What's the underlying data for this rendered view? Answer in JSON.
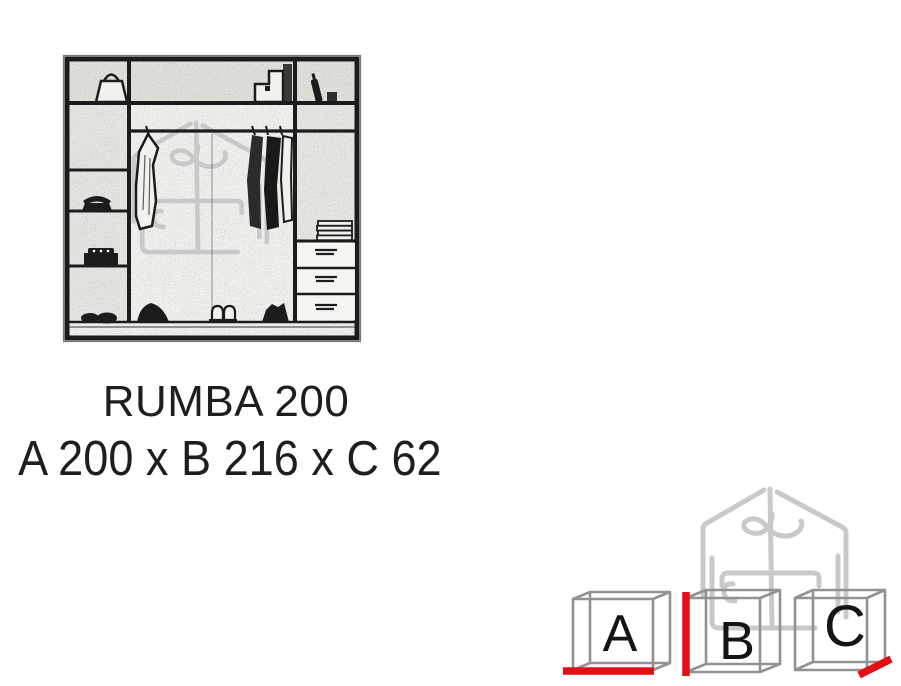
{
  "product": {
    "name": "RUMBA 200",
    "dimensions_label": "A 200 x B 216 x C 62"
  },
  "dimension_cubes": [
    {
      "label": "A",
      "dimension": "width",
      "value": "200",
      "highlighted_edge": "bottom-front"
    },
    {
      "label": "B",
      "dimension": "height",
      "value": "216",
      "highlighted_edge": "left-front"
    },
    {
      "label": "C",
      "dimension": "depth",
      "value": "62",
      "highlighted_edge": "bottom-right-receding"
    }
  ],
  "diagram": {
    "type": "wardrobe interior sketch",
    "depicts": [
      "shelves with bag",
      "hanging rail with clothes",
      "three drawers",
      "folded linens",
      "shoes",
      "telephone",
      "bottle"
    ]
  },
  "watermark": {
    "icon": "house-hanger-furniture-logo"
  },
  "colors": {
    "accent_red": "#e30f17",
    "cube_gray": "#8f9394",
    "watermark_gray": "#c8cac9",
    "ink": "#1c1c1c",
    "background": "#ffffff"
  }
}
